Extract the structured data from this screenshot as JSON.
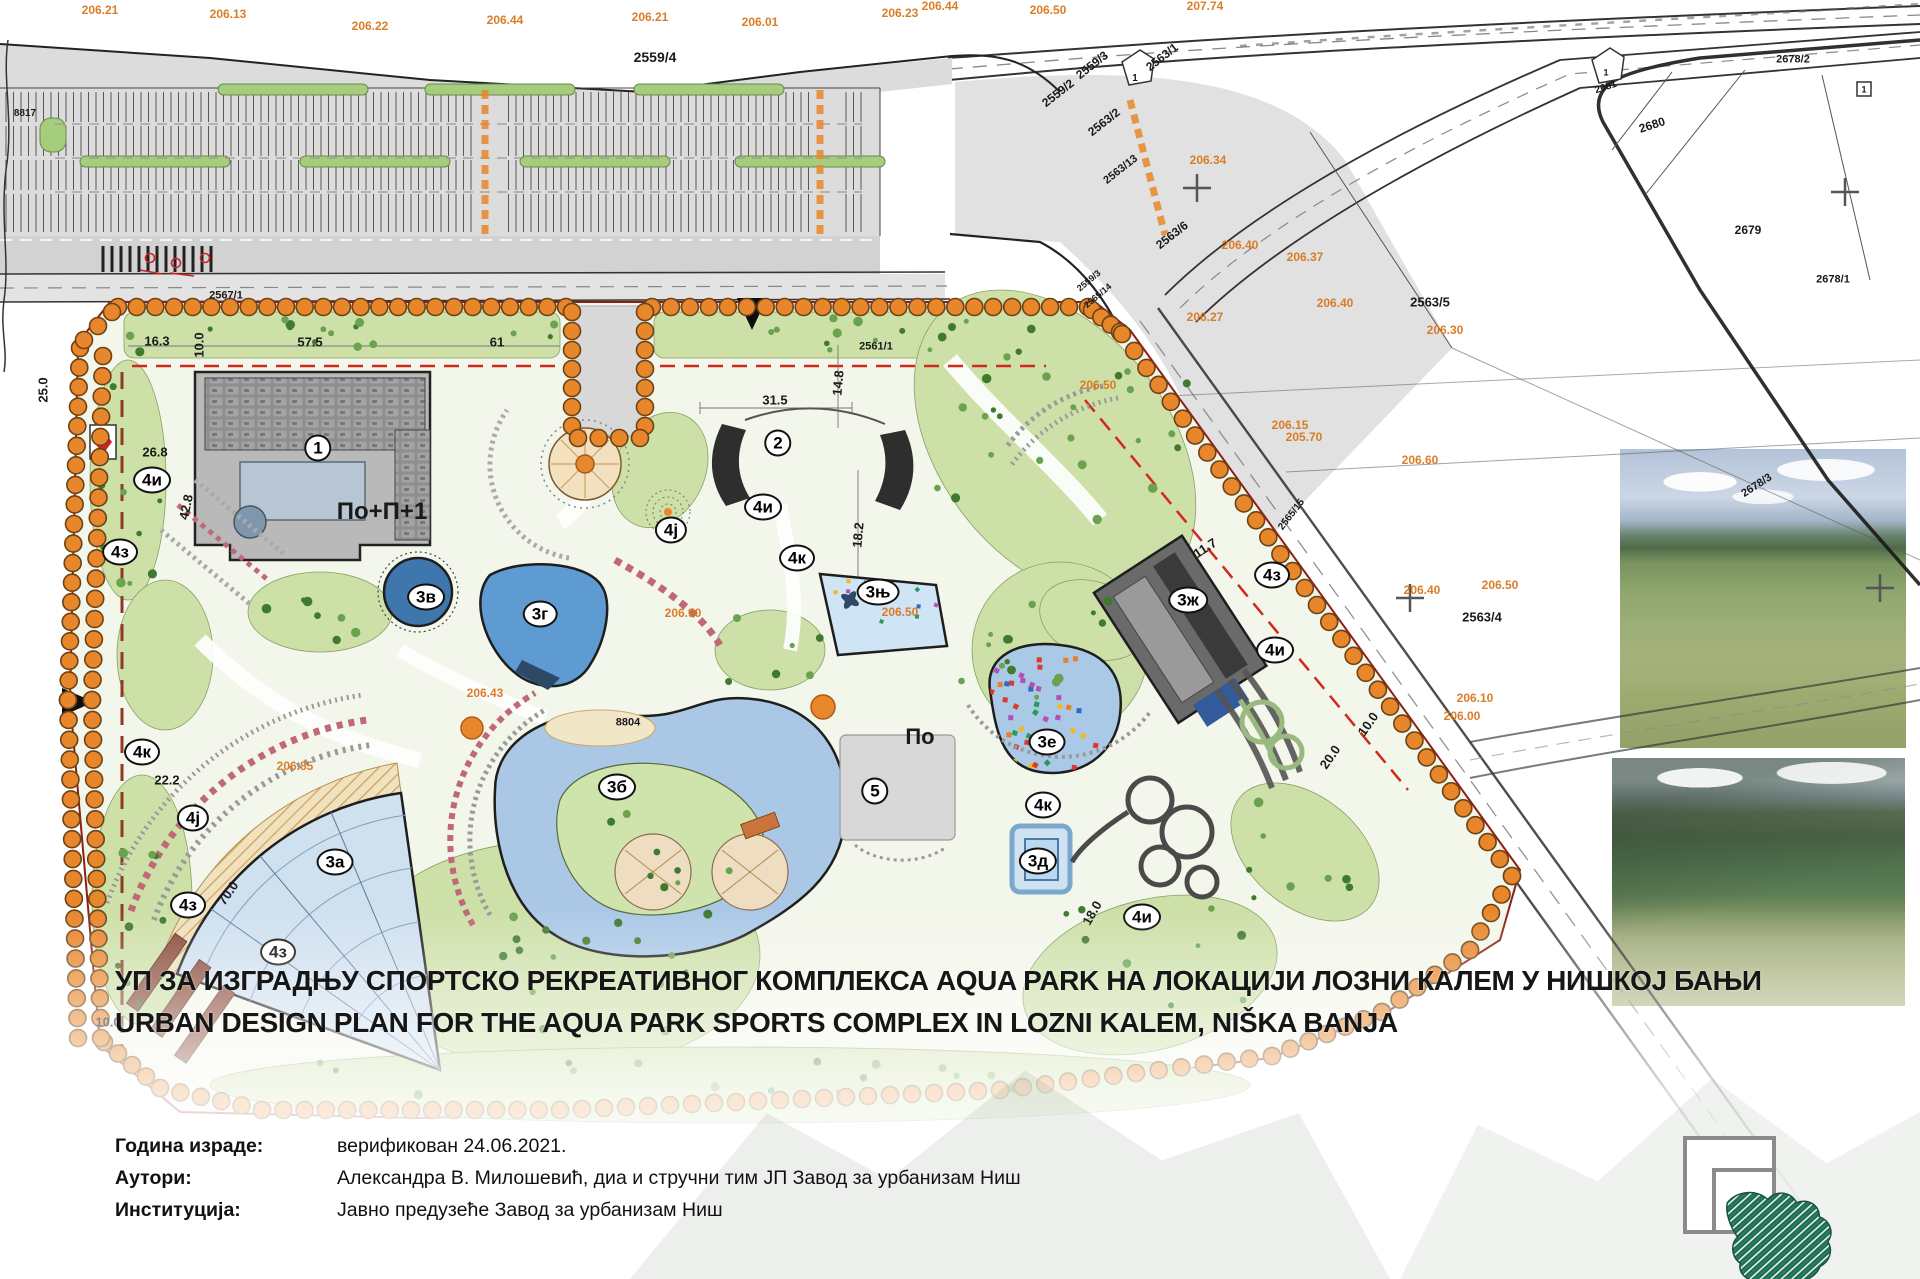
{
  "title": {
    "line1_sr": "УП ЗА ИЗГРАДЊУ СПОРТСКО РЕКРЕАТИВНОГ КОМПЛЕКСА AQUA PARK НА ЛОКАЦИЈИ ЛОЗНИ КАЛЕМ У НИШКОЈ БАЊИ",
    "line2_en": "URBAN DESIGN PLAN FOR THE AQUA PARK SPORTS COMPLEX IN LOZNI KALEM, NIŠKA BANJA"
  },
  "metadata": {
    "rows": [
      {
        "label": "Година израде:",
        "value": "верификован 24.06.2021."
      },
      {
        "label": "Аутори:",
        "value": "Александра В. Милошевић, диа и стручни тим ЈП Завод за урбанизам Ниш"
      },
      {
        "label": "Институција:",
        "value": "Јавно предузеће Завод за урбанизам Ниш"
      }
    ]
  },
  "map": {
    "circle_labels": [
      {
        "t": "1",
        "x": 318,
        "y": 448
      },
      {
        "t": "2",
        "x": 778,
        "y": 443
      },
      {
        "t": "5",
        "x": 875,
        "y": 791
      },
      {
        "t": "3а",
        "x": 335,
        "y": 862
      },
      {
        "t": "3б",
        "x": 617,
        "y": 787
      },
      {
        "t": "3в",
        "x": 426,
        "y": 597
      },
      {
        "t": "3г",
        "x": 540,
        "y": 614
      },
      {
        "t": "3д",
        "x": 1038,
        "y": 861
      },
      {
        "t": "3е",
        "x": 1047,
        "y": 742
      },
      {
        "t": "3ж",
        "x": 1188,
        "y": 600
      },
      {
        "t": "3њ",
        "x": 878,
        "y": 592
      },
      {
        "t": "4и",
        "x": 152,
        "y": 480
      },
      {
        "t": "4и",
        "x": 763,
        "y": 507
      },
      {
        "t": "4и",
        "x": 1142,
        "y": 917
      },
      {
        "t": "4и",
        "x": 1275,
        "y": 650
      },
      {
        "t": "4ј",
        "x": 193,
        "y": 818
      },
      {
        "t": "4ј",
        "x": 671,
        "y": 530
      },
      {
        "t": "4з",
        "x": 120,
        "y": 552
      },
      {
        "t": "4з",
        "x": 188,
        "y": 905
      },
      {
        "t": "4з",
        "x": 278,
        "y": 952
      },
      {
        "t": "4з",
        "x": 1272,
        "y": 575
      },
      {
        "t": "4к",
        "x": 142,
        "y": 752
      },
      {
        "t": "4к",
        "x": 797,
        "y": 558
      },
      {
        "t": "4к",
        "x": 1043,
        "y": 805
      }
    ],
    "black_labels": [
      {
        "t": "По+П+1",
        "x": 382,
        "y": 512,
        "s": 24,
        "b": 1
      },
      {
        "t": "По",
        "x": 920,
        "y": 737,
        "s": 22,
        "b": 1
      },
      {
        "t": "2559/4",
        "x": 655,
        "y": 57,
        "s": 14,
        "b": 1
      },
      {
        "t": "2559/3",
        "x": 1092,
        "y": 65,
        "s": 12,
        "b": 1,
        "r": -38
      },
      {
        "t": "2559/2",
        "x": 1058,
        "y": 93,
        "s": 12,
        "b": 1,
        "r": -38
      },
      {
        "t": "2563/1",
        "x": 1162,
        "y": 57,
        "s": 12,
        "b": 1,
        "r": -38
      },
      {
        "t": "2563/2",
        "x": 1104,
        "y": 122,
        "s": 12,
        "b": 1,
        "r": -38
      },
      {
        "t": "2563/13",
        "x": 1121,
        "y": 170,
        "s": 11,
        "b": 1,
        "r": -38
      },
      {
        "t": "2563/6",
        "x": 1172,
        "y": 235,
        "s": 12,
        "b": 1,
        "r": -38
      },
      {
        "t": "2563/5",
        "x": 1430,
        "y": 302,
        "s": 13,
        "b": 1
      },
      {
        "t": "2563/4",
        "x": 1482,
        "y": 617,
        "s": 13,
        "b": 1
      },
      {
        "t": "2680",
        "x": 1652,
        "y": 125,
        "s": 12,
        "b": 1,
        "r": -18
      },
      {
        "t": "2681",
        "x": 1606,
        "y": 88,
        "s": 10,
        "b": 1,
        "r": -18
      },
      {
        "t": "2679",
        "x": 1748,
        "y": 230,
        "s": 12,
        "b": 1
      },
      {
        "t": "2678/1",
        "x": 1833,
        "y": 280,
        "s": 11,
        "b": 1
      },
      {
        "t": "2678/2",
        "x": 1793,
        "y": 60,
        "s": 11,
        "b": 1
      },
      {
        "t": "2678/3",
        "x": 1757,
        "y": 486,
        "s": 11,
        "b": 1,
        "r": -33
      },
      {
        "t": "2567/1",
        "x": 226,
        "y": 296,
        "s": 11,
        "b": 1
      },
      {
        "t": "2561/1",
        "x": 876,
        "y": 347,
        "s": 11,
        "b": 1
      },
      {
        "t": "2559/3",
        "x": 1089,
        "y": 281,
        "s": 9,
        "b": 1,
        "r": -40
      },
      {
        "t": "2565/14",
        "x": 1098,
        "y": 296,
        "s": 9,
        "b": 1,
        "r": -40
      },
      {
        "t": "2565/15",
        "x": 1292,
        "y": 515,
        "s": 10,
        "b": 1,
        "r": -52
      },
      {
        "t": "8804",
        "x": 628,
        "y": 723,
        "s": 11,
        "b": 1
      },
      {
        "t": "8817",
        "x": 25,
        "y": 114,
        "s": 10,
        "b": 1
      },
      {
        "t": "1",
        "x": 1135,
        "y": 79,
        "s": 10,
        "b": 1
      },
      {
        "t": "1",
        "x": 1606,
        "y": 73,
        "s": 9,
        "b": 1
      },
      {
        "t": "1",
        "x": 1864,
        "y": 90,
        "s": 9,
        "b": 1
      }
    ],
    "dimensions": [
      {
        "t": "16.3",
        "x": 157,
        "y": 341
      },
      {
        "t": "10.0",
        "x": 199,
        "y": 345,
        "r": -90
      },
      {
        "t": "57.5",
        "x": 310,
        "y": 342
      },
      {
        "t": "61",
        "x": 497,
        "y": 342
      },
      {
        "t": "26.8",
        "x": 155,
        "y": 452
      },
      {
        "t": "42.8",
        "x": 186,
        "y": 507,
        "r": -78
      },
      {
        "t": "31.5",
        "x": 775,
        "y": 400
      },
      {
        "t": "14.8",
        "x": 838,
        "y": 383,
        "r": -85
      },
      {
        "t": "18.2",
        "x": 858,
        "y": 535,
        "r": -85
      },
      {
        "t": "22.2",
        "x": 167,
        "y": 780
      },
      {
        "t": "70.0",
        "x": 228,
        "y": 893,
        "r": -55
      },
      {
        "t": "25.0",
        "x": 43,
        "y": 390,
        "r": -90
      },
      {
        "t": "11.7",
        "x": 1205,
        "y": 548,
        "r": -33
      },
      {
        "t": "10.0",
        "x": 1368,
        "y": 724,
        "r": -55
      },
      {
        "t": "20.0",
        "x": 1330,
        "y": 757,
        "r": -55
      },
      {
        "t": "10.0",
        "x": 108,
        "y": 1022
      },
      {
        "t": "18.0",
        "x": 1092,
        "y": 913,
        "r": -60
      }
    ],
    "elevations": [
      {
        "t": "206.21",
        "x": 100,
        "y": 10
      },
      {
        "t": "206.13",
        "x": 228,
        "y": 14
      },
      {
        "t": "206.22",
        "x": 370,
        "y": 26
      },
      {
        "t": "206.44",
        "x": 505,
        "y": 20
      },
      {
        "t": "206.21",
        "x": 650,
        "y": 17
      },
      {
        "t": "206.01",
        "x": 760,
        "y": 22
      },
      {
        "t": "206.23",
        "x": 900,
        "y": 13
      },
      {
        "t": "206.44",
        "x": 940,
        "y": 6
      },
      {
        "t": "206.50",
        "x": 1048,
        "y": 10
      },
      {
        "t": "207.74",
        "x": 1205,
        "y": 6
      },
      {
        "t": "206.34",
        "x": 1208,
        "y": 160
      },
      {
        "t": "206.40",
        "x": 1240,
        "y": 245
      },
      {
        "t": "206.37",
        "x": 1305,
        "y": 257
      },
      {
        "t": "206.27",
        "x": 1205,
        "y": 317
      },
      {
        "t": "206.40",
        "x": 1335,
        "y": 303
      },
      {
        "t": "206.30",
        "x": 1445,
        "y": 330
      },
      {
        "t": "206.50",
        "x": 1098,
        "y": 385
      },
      {
        "t": "206.15",
        "x": 1290,
        "y": 425
      },
      {
        "t": "205.70",
        "x": 1304,
        "y": 437
      },
      {
        "t": "206.60",
        "x": 1420,
        "y": 460
      },
      {
        "t": "206.50",
        "x": 1500,
        "y": 585
      },
      {
        "t": "206.40",
        "x": 1422,
        "y": 590
      },
      {
        "t": "206.10",
        "x": 1475,
        "y": 698
      },
      {
        "t": "206.00",
        "x": 1462,
        "y": 716
      },
      {
        "t": "206.43",
        "x": 485,
        "y": 693
      },
      {
        "t": "206.90",
        "x": 683,
        "y": 613
      },
      {
        "t": "206.85",
        "x": 295,
        "y": 766
      },
      {
        "t": "206.50",
        "x": 900,
        "y": 612
      }
    ]
  },
  "colors": {
    "tree_orange": "#e8862b",
    "red_dash": "#cf2a1b",
    "boundary_red": "#8e1f14",
    "pool_blue": "#a9c9e6",
    "deep_pool_blue": "#4679ad",
    "lawn_green": "#cde0a8",
    "elevation_orange": "#d9771e",
    "logo_green": "#1e6b52"
  }
}
